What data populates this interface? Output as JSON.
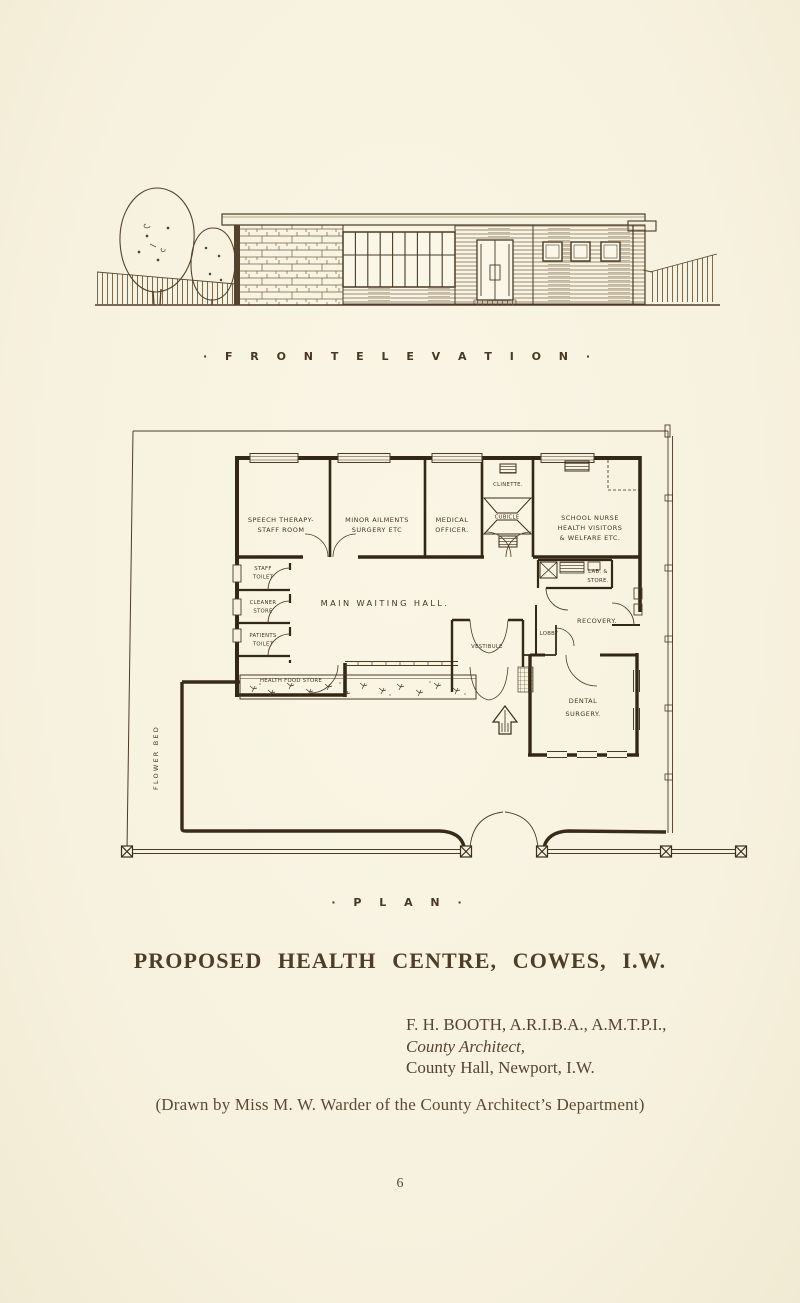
{
  "page": {
    "number": "6"
  },
  "captions": {
    "elevation": "· F R O N T   E L E V A T I O N ·",
    "plan": "· P L A N ·"
  },
  "title": "PROPOSED HEALTH CENTRE, COWES, I.W.",
  "credit": {
    "line1": "F. H. BOOTH, A.R.I.B.A., A.M.T.P.I.,",
    "line2": "County Architect,",
    "line3": "County Hall, Newport, I.W."
  },
  "drawn_by": "(Drawn by Miss M. W. Warder of the County Architect’s Department)",
  "colors": {
    "paper": "#f7f2df",
    "ink": "#46381f",
    "wall": "#352a18"
  },
  "plan_labels": {
    "speech_1": "SPEECH THERAPY-",
    "speech_2": "STAFF ROOM",
    "minor_1": "MINOR AILMENTS",
    "minor_2": "SURGERY ETC",
    "medical_1": "MEDICAL",
    "medical_2": "OFFICER.",
    "clinette": "CLINETTE.",
    "cubicle": "CUBICLE",
    "nurse_1": "SCHOOL NURSE",
    "nurse_2": "HEALTH VISITORS",
    "nurse_3": "& WELFARE ETC.",
    "staff_toilet_1": "STAFF",
    "staff_toilet_2": "TOILET",
    "cleaner_1": "CLEANER",
    "cleaner_2": "STORE",
    "patients_1": "PATIENTS",
    "patients_2": "TOILET",
    "waiting_hall": "MAIN WAITING HALL.",
    "health_food": "HEALTH FOOD STORE",
    "lab_1": "LAB. &",
    "lab_2": "STORE.",
    "recovery": "RECOVERY.",
    "vestibule": "VESTIBULE",
    "lobby": "LOBBY",
    "dental_1": "DENTAL",
    "dental_2": "SURGERY.",
    "flower_bed": "FLOWER  BED"
  }
}
